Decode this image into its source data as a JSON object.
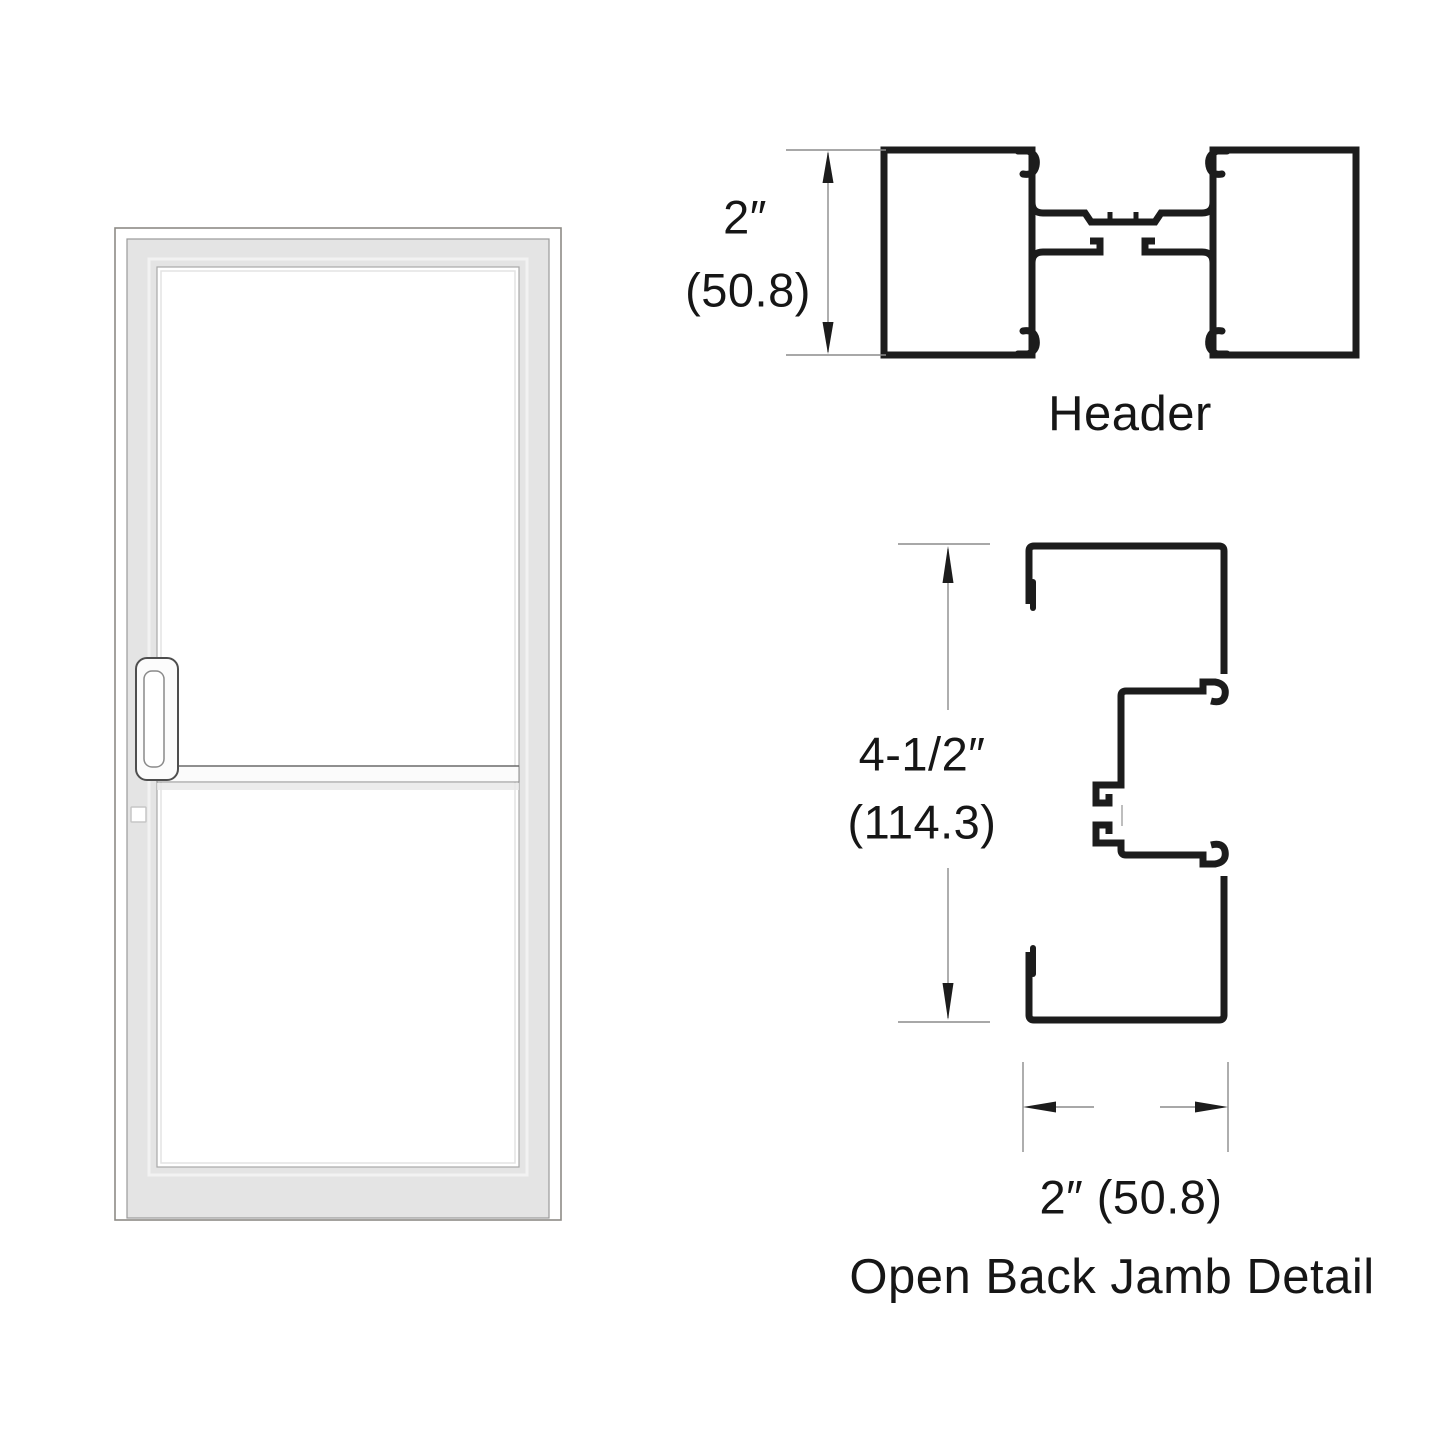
{
  "drawing": {
    "background_color": "#ffffff",
    "profile_line_color": "#1c1c1c",
    "dimension_line_color": "#8c8c8c",
    "text_color": "#161616",
    "door_frame_color": "#e4e4e4"
  },
  "header_detail": {
    "dimension_inches": "2″",
    "dimension_mm": "(50.8)",
    "caption": "Header"
  },
  "jamb_detail": {
    "height_inches": "4-1/2″",
    "height_mm": "(114.3)",
    "width_dimension": "2″ (50.8)",
    "caption": "Open Back Jamb Detail"
  }
}
